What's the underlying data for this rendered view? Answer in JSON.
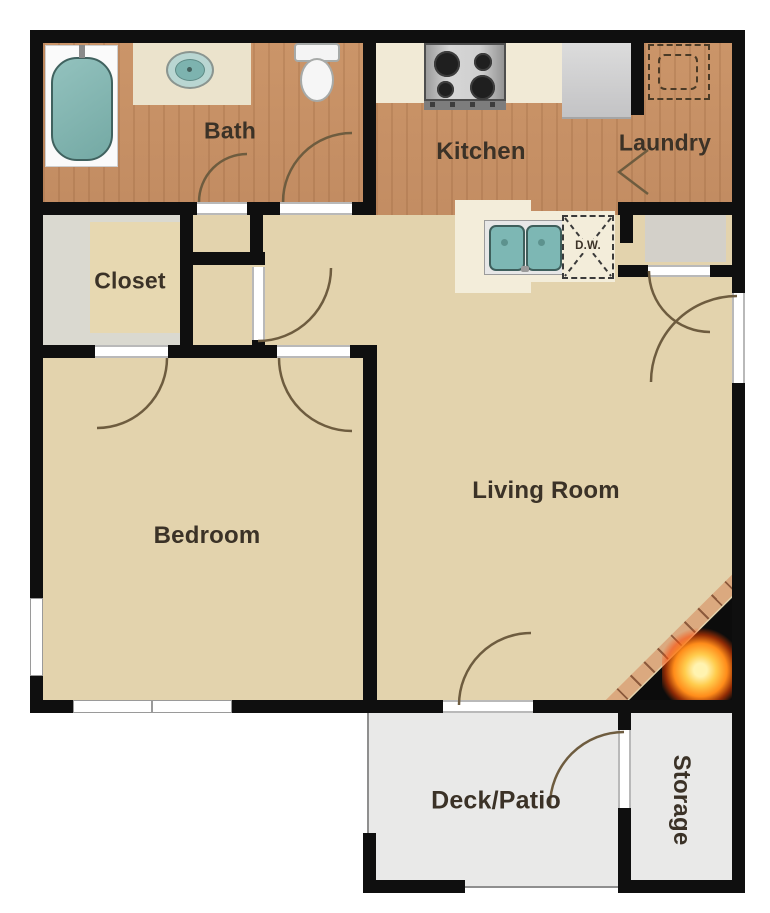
{
  "floor_plan": {
    "rooms": [
      {
        "name": "bath",
        "label": "Bath"
      },
      {
        "name": "kitchen",
        "label": "Kitchen"
      },
      {
        "name": "laundry",
        "label": "Laundry"
      },
      {
        "name": "closet",
        "label": "Closet"
      },
      {
        "name": "bedroom",
        "label": "Bedroom"
      },
      {
        "name": "living-room",
        "label": "Living Room"
      },
      {
        "name": "deck-patio",
        "label": "Deck/Patio"
      },
      {
        "name": "storage",
        "label": "Storage"
      }
    ],
    "appliances": {
      "dishwasher_label": "D.W."
    },
    "fixtures": [
      "bathtub",
      "bathroom-sink",
      "toilet",
      "stove",
      "refrigerator",
      "washer-dryer-hookup",
      "kitchen-double-sink",
      "dishwasher",
      "fireplace",
      "entry-door",
      "patio-door",
      "windows"
    ],
    "colors": {
      "wall": "#0f0f0f",
      "wood_floor": "#c8926a",
      "tan_floor": "#e3d3ad",
      "closet_floor": "#dad9d0",
      "closet_rug": "#e7d8b1",
      "deck_floor": "#e9e9e8",
      "counter_cream": "#f3edda",
      "fixture_teal": "#7db7b4",
      "flame_orange": "#ff8c1a",
      "brick": "#dba97f"
    }
  }
}
